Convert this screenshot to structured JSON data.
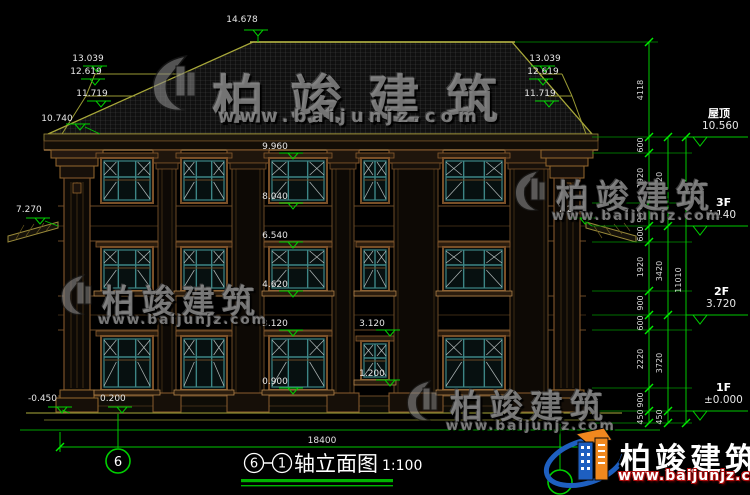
{
  "title_block": {
    "axis_start": "6",
    "axis_end": "1",
    "title": "轴立面图",
    "scale": "1:100"
  },
  "axis_bubbles": {
    "left": "6"
  },
  "levels": {
    "peak": "14.678",
    "left_roof": [
      "13.039",
      "12.619",
      "11.719"
    ],
    "left_eave": "10.740",
    "left_awning": "7.270",
    "right_roof": [
      "13.039",
      "12.619",
      "11.719"
    ],
    "right_awning": "7.270",
    "floor_marks": [
      "9.960",
      "8.040",
      "6.540",
      "4.620",
      "3.120",
      "0.900"
    ],
    "stair_marks": [
      "3.120",
      "1.200"
    ],
    "ground_low": "-0.450",
    "ground_high": "0.200"
  },
  "dimensions": {
    "total_width": "18400",
    "col_segments": [
      "4118",
      "600",
      "1920",
      "900",
      "600",
      "1920",
      "900",
      "600",
      "2220",
      "900",
      "450"
    ],
    "floor_segments": [
      "3420",
      "3420",
      "3720",
      "450"
    ],
    "overall_height": "11010",
    "story_levels": [
      {
        "name": "屋顶",
        "value": "10.560"
      },
      {
        "name": "3F",
        "value": "7.140"
      },
      {
        "name": "2F",
        "value": "3.720"
      },
      {
        "name": "1F",
        "value": "±0.000"
      }
    ]
  },
  "watermark": {
    "brand": "柏竣建筑",
    "url": "www.baijunjz.com"
  },
  "logo": {
    "brand": "柏竣建筑",
    "url": "www.baijunjz.com"
  },
  "colors": {
    "dim_green": "#00c800",
    "roof_olive": "#a8a83a",
    "wood_brown": "#8a5c2e",
    "window_teal": "#3d8585",
    "logo_blue": "#1e5fc0",
    "logo_orange": "#f0881e"
  }
}
